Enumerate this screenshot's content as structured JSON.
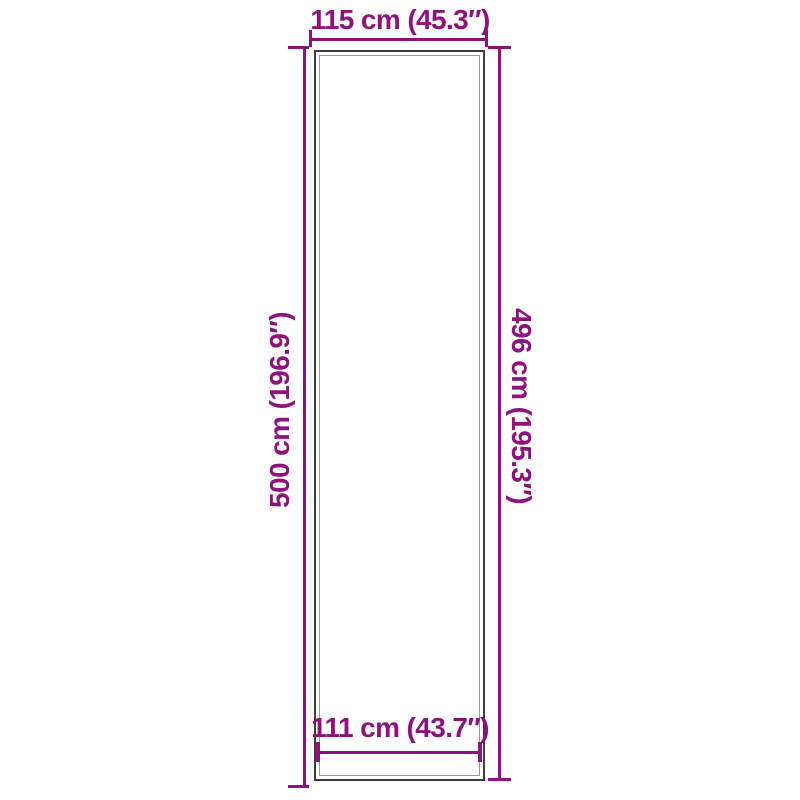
{
  "figure": {
    "kind": "product-dimension-diagram",
    "colors": {
      "accent": "#8E127E",
      "outline": "#3E3E3E",
      "inner_edge": "#999999",
      "background": "#FFFFFF"
    },
    "dimensions": {
      "outer_width": {
        "label": "115 cm (45.3″)"
      },
      "outer_length": {
        "label": "500 cm (196.9″)"
      },
      "inner_length": {
        "label": "496 cm (195.3″)"
      },
      "inner_width": {
        "label": "111 cm (43.7″)"
      }
    }
  }
}
